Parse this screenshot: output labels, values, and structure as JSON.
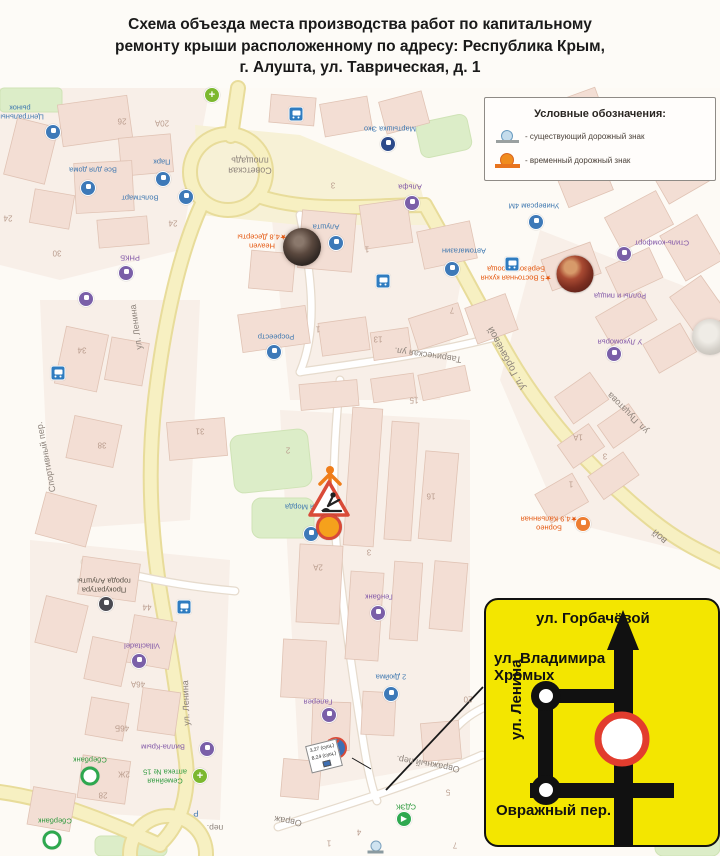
{
  "page": {
    "title": "Схема объезда места производства работ по капитальному\nремонту крыши расположенному по адресу: Республика Крым,\nг. Алушта, ул. Таврическая, д. 1"
  },
  "legend": {
    "title": "Условные обозначения:",
    "items": [
      {
        "kind": "existing-sign-symbol",
        "label": "- существующий дорожный знак"
      },
      {
        "kind": "temporary-sign-symbol",
        "label": "- временный дорожный знак"
      }
    ]
  },
  "work_signs": {
    "temporary_sign_number": "3.2",
    "existing_sign_row1": "3.27 (сущ.)",
    "existing_sign_row2": "8.24 (сущ.)"
  },
  "inset": {
    "street_top": "ул. Горбачёвой",
    "street_left": "ул. Владимира\nХромых",
    "street_vertical": "ул. Ленина",
    "street_bottom": "Овражный пер."
  },
  "colors": {
    "inset_background": "#f3e600",
    "prohibition_ring": "#e23d2e",
    "temporary_sign": "#f08c1e",
    "existing_sign": "#c4dcec",
    "main_road": "#f7f0c2"
  },
  "map": {
    "labels": [
      {
        "t": "Центральный\nрынок",
        "x": 20,
        "y": 112,
        "r": 180,
        "c": "blue",
        "s": 7.5
      },
      {
        "t": "26",
        "x": 122,
        "y": 121,
        "r": 180,
        "c": "num",
        "s": 8
      },
      {
        "t": "20А",
        "x": 162,
        "y": 123,
        "r": 180,
        "c": "num",
        "s": 8
      },
      {
        "t": "Все для дома",
        "x": 93,
        "y": 169,
        "r": 180,
        "c": "blue",
        "s": 7.5
      },
      {
        "t": "Парк",
        "x": 162,
        "y": 161,
        "r": 180,
        "c": "blue",
        "s": 7.5
      },
      {
        "t": "Вольтмарт",
        "x": 140,
        "y": 197,
        "r": 180,
        "c": "blue",
        "s": 7.5
      },
      {
        "t": "24",
        "x": 173,
        "y": 223,
        "r": 180,
        "c": "num",
        "s": 8
      },
      {
        "t": "24",
        "x": 8,
        "y": 218,
        "r": 180,
        "c": "num",
        "s": 8
      },
      {
        "t": "30",
        "x": 57,
        "y": 253,
        "r": 180,
        "c": "num",
        "s": 8
      },
      {
        "t": "РНКБ",
        "x": 130,
        "y": 257,
        "r": 180,
        "c": "purple",
        "s": 7.5
      },
      {
        "t": "Советская\nплощадь",
        "x": 250,
        "y": 165,
        "r": 180,
        "c": "street",
        "s": 9
      },
      {
        "t": "Мартышка Эко",
        "x": 390,
        "y": 128,
        "r": 180,
        "c": "blue",
        "s": 7.5
      },
      {
        "t": "Альфа",
        "x": 410,
        "y": 186,
        "r": 180,
        "c": "purple",
        "s": 7.5
      },
      {
        "t": "3",
        "x": 333,
        "y": 185,
        "r": 180,
        "c": "num",
        "s": 8
      },
      {
        "t": "Алушта",
        "x": 326,
        "y": 226,
        "r": 180,
        "c": "blue",
        "s": 7.5
      },
      {
        "t": "1",
        "x": 367,
        "y": 249,
        "r": 180,
        "c": "num",
        "s": 8
      },
      {
        "t": "Heaven\n★4.8 Десерты",
        "x": 262,
        "y": 241,
        "r": 180,
        "c": "orange",
        "s": 7.5
      },
      {
        "t": "Автомагазин",
        "x": 464,
        "y": 250,
        "r": 180,
        "c": "blue",
        "s": 7.5
      },
      {
        "t": "1А",
        "x": 383,
        "y": 282,
        "r": 180,
        "c": "num",
        "s": 8
      },
      {
        "t": "Универсам 4М",
        "x": 534,
        "y": 205,
        "r": 180,
        "c": "blue",
        "s": 7.5
      },
      {
        "t": "Стиль-комфорт",
        "x": 662,
        "y": 242,
        "r": 180,
        "c": "purple",
        "s": 7.5
      },
      {
        "t": "★5 Восточная кухня\nБерёзовая роща",
        "x": 516,
        "y": 273,
        "r": 180,
        "c": "orange",
        "s": 7.5
      },
      {
        "t": "Роллы и пицца",
        "x": 620,
        "y": 295,
        "r": 180,
        "c": "purple",
        "s": 7.5
      },
      {
        "t": "У Лукоморья",
        "x": 620,
        "y": 341,
        "r": 180,
        "c": "purple",
        "s": 7.5
      },
      {
        "t": "ул. Пуцатова",
        "x": 628,
        "y": 413,
        "r": 225,
        "c": "street",
        "s": 9
      },
      {
        "t": "ул. Горбачёвой",
        "x": 507,
        "y": 358,
        "r": 242,
        "c": "street",
        "s": 10
      },
      {
        "t": "вой",
        "x": 660,
        "y": 536,
        "r": 222,
        "c": "street",
        "s": 10
      },
      {
        "t": "Таврическая ул.",
        "x": 428,
        "y": 355,
        "r": 188,
        "c": "street",
        "s": 9
      },
      {
        "t": "Росреестр",
        "x": 276,
        "y": 336,
        "r": 180,
        "c": "blue",
        "s": 7.5
      },
      {
        "t": "1",
        "x": 318,
        "y": 329,
        "r": 180,
        "c": "num",
        "s": 8
      },
      {
        "t": "13",
        "x": 378,
        "y": 339,
        "r": 180,
        "c": "num",
        "s": 8
      },
      {
        "t": "15",
        "x": 414,
        "y": 400,
        "r": 180,
        "c": "num",
        "s": 8
      },
      {
        "t": "7",
        "x": 452,
        "y": 310,
        "r": 180,
        "c": "num",
        "s": 8
      },
      {
        "t": "ул. Ленина",
        "x": 136,
        "y": 327,
        "r": 262,
        "c": "street",
        "s": 9
      },
      {
        "t": "ул. Ленина",
        "x": 186,
        "y": 703,
        "r": 268,
        "c": "street",
        "s": 9
      },
      {
        "t": "Спортивный пер.",
        "x": 46,
        "y": 457,
        "r": 259,
        "c": "street",
        "s": 9
      },
      {
        "t": "34",
        "x": 82,
        "y": 350,
        "r": 180,
        "c": "num",
        "s": 8
      },
      {
        "t": "38",
        "x": 102,
        "y": 445,
        "r": 180,
        "c": "num",
        "s": 8
      },
      {
        "t": "31",
        "x": 200,
        "y": 431,
        "r": 180,
        "c": "num",
        "s": 8
      },
      {
        "t": "Тайная Морда",
        "x": 310,
        "y": 506,
        "r": 180,
        "c": "blue",
        "s": 7.5
      },
      {
        "t": "16",
        "x": 431,
        "y": 496,
        "r": 180,
        "c": "num",
        "s": 8
      },
      {
        "t": "2А",
        "x": 318,
        "y": 567,
        "r": 180,
        "c": "num",
        "s": 8
      },
      {
        "t": "3",
        "x": 369,
        "y": 552,
        "r": 180,
        "c": "num",
        "s": 8
      },
      {
        "t": "2",
        "x": 288,
        "y": 450,
        "r": 180,
        "c": "num",
        "s": 8
      },
      {
        "t": "Генбанк",
        "x": 379,
        "y": 596,
        "r": 180,
        "c": "purple",
        "s": 7.5
      },
      {
        "t": "Борнео\n★4.9 Кальянная",
        "x": 549,
        "y": 523,
        "r": 180,
        "c": "orange",
        "s": 7.5
      },
      {
        "t": "1А",
        "x": 578,
        "y": 437,
        "r": 180,
        "c": "num",
        "s": 8
      },
      {
        "t": "3",
        "x": 605,
        "y": 456,
        "r": 180,
        "c": "num",
        "s": 8
      },
      {
        "t": "1",
        "x": 571,
        "y": 484,
        "r": 180,
        "c": "num",
        "s": 8
      },
      {
        "t": "Прокуратура\nгорода Алушты",
        "x": 104,
        "y": 585,
        "r": 180,
        "c": "dark",
        "s": 7.5
      },
      {
        "t": "44",
        "x": 147,
        "y": 607,
        "r": 180,
        "c": "num",
        "s": 8
      },
      {
        "t": "Villacitadel",
        "x": 142,
        "y": 645,
        "r": 180,
        "c": "purple",
        "s": 7.5
      },
      {
        "t": "46А",
        "x": 138,
        "y": 684,
        "r": 180,
        "c": "num",
        "s": 8
      },
      {
        "t": "46Б",
        "x": 122,
        "y": 728,
        "r": 180,
        "c": "num",
        "s": 8
      },
      {
        "t": "Сбербанк",
        "x": 90,
        "y": 759,
        "r": 180,
        "c": "green",
        "s": 7.5
      },
      {
        "t": "2Ж",
        "x": 124,
        "y": 774,
        "r": 180,
        "c": "num",
        "s": 8
      },
      {
        "t": "Вилла-Крым",
        "x": 163,
        "y": 746,
        "r": 180,
        "c": "purple",
        "s": 7.5
      },
      {
        "t": "Семейная\nаптека № 15",
        "x": 165,
        "y": 776,
        "r": 180,
        "c": "green",
        "s": 7.5
      },
      {
        "t": "28",
        "x": 103,
        "y": 795,
        "r": 180,
        "c": "num",
        "s": 8
      },
      {
        "t": "Сбербанк",
        "x": 55,
        "y": 820,
        "r": 180,
        "c": "green",
        "s": 7.5
      },
      {
        "t": "Р",
        "x": 196,
        "y": 813,
        "r": 180,
        "c": "blue",
        "s": 8
      },
      {
        "t": "пер.",
        "x": 215,
        "y": 827,
        "r": 180,
        "c": "street",
        "s": 8.5
      },
      {
        "t": "Овражный пер.",
        "x": 428,
        "y": 764,
        "r": 190,
        "c": "street",
        "s": 9
      },
      {
        "t": "Овраж",
        "x": 288,
        "y": 821,
        "r": 190,
        "c": "street",
        "s": 9
      },
      {
        "t": "2 Дюйма",
        "x": 391,
        "y": 676,
        "r": 180,
        "c": "blue",
        "s": 7.5
      },
      {
        "t": "Галерея",
        "x": 318,
        "y": 701,
        "r": 180,
        "c": "purple",
        "s": 7.5
      },
      {
        "t": "20",
        "x": 468,
        "y": 699,
        "r": 180,
        "c": "num",
        "s": 8
      },
      {
        "t": "СДЭК",
        "x": 406,
        "y": 806,
        "r": 180,
        "c": "green",
        "s": 7.5
      },
      {
        "t": "5",
        "x": 448,
        "y": 792,
        "r": 180,
        "c": "num",
        "s": 8
      },
      {
        "t": "4",
        "x": 359,
        "y": 832,
        "r": 180,
        "c": "num",
        "s": 8
      },
      {
        "t": "7",
        "x": 455,
        "y": 845,
        "r": 180,
        "c": "num",
        "s": 8
      },
      {
        "t": "1",
        "x": 329,
        "y": 843,
        "r": 180,
        "c": "num",
        "s": 8
      }
    ],
    "icons": [
      {
        "k": "blue",
        "x": 53,
        "y": 132,
        "n": "market-poi-icon"
      },
      {
        "k": "blue",
        "x": 88,
        "y": 188,
        "n": "vse-dlya-doma-poi-icon"
      },
      {
        "k": "blue",
        "x": 163,
        "y": 179,
        "n": "park-poi-icon"
      },
      {
        "k": "blue",
        "x": 186,
        "y": 197,
        "n": "voltmart-poi-icon"
      },
      {
        "k": "purple",
        "x": 126,
        "y": 273,
        "n": "rnkb-poi-icon"
      },
      {
        "k": "bus",
        "x": 296,
        "y": 114,
        "n": "bus-stop-icon"
      },
      {
        "k": "bus",
        "x": 383,
        "y": 266,
        "n": "bus-stop-icon"
      },
      {
        "k": "bus",
        "x": 512,
        "y": 234,
        "n": "bus-stop-icon"
      },
      {
        "k": "bus",
        "x": 184,
        "y": 562,
        "n": "bus-stop-icon"
      },
      {
        "k": "bus",
        "x": 58,
        "y": 313,
        "n": "bus-stop-icon"
      },
      {
        "k": "darkblue",
        "x": 388,
        "y": 144,
        "n": "martyshka-poi-icon"
      },
      {
        "k": "purple",
        "x": 412,
        "y": 203,
        "n": "alfa-poi-icon"
      },
      {
        "k": "blue",
        "x": 336,
        "y": 243,
        "n": "alushta-poi-icon"
      },
      {
        "k": "blue",
        "x": 452,
        "y": 269,
        "n": "avtomagazin-poi-icon"
      },
      {
        "k": "blue",
        "x": 536,
        "y": 222,
        "n": "universam-poi-icon"
      },
      {
        "k": "purple",
        "x": 624,
        "y": 254,
        "n": "stil-komfort-poi-icon"
      },
      {
        "k": "purple",
        "x": 614,
        "y": 354,
        "n": "lukomorye-poi-icon"
      },
      {
        "k": "blue",
        "x": 274,
        "y": 352,
        "n": "rosreestr-poi-icon"
      },
      {
        "k": "purple",
        "x": 86,
        "y": 299,
        "n": "poi-icon"
      },
      {
        "k": "greenplus",
        "x": 212,
        "y": 95,
        "n": "pharmacy-icon"
      },
      {
        "k": "dark",
        "x": 106,
        "y": 604,
        "n": "prosecutor-poi-icon"
      },
      {
        "k": "purple",
        "x": 139,
        "y": 661,
        "n": "villacitadel-poi-icon"
      },
      {
        "k": "sber",
        "x": 90,
        "y": 776,
        "n": "sberbank-icon"
      },
      {
        "k": "sber",
        "x": 52,
        "y": 840,
        "n": "sberbank-icon"
      },
      {
        "k": "purple",
        "x": 207,
        "y": 749,
        "n": "villa-krym-poi-icon"
      },
      {
        "k": "greenplus",
        "x": 200,
        "y": 776,
        "n": "pharmacy-icon"
      },
      {
        "k": "purple",
        "x": 378,
        "y": 613,
        "n": "genbank-poi-icon"
      },
      {
        "k": "blue",
        "x": 391,
        "y": 694,
        "n": "2-dyuyma-poi-icon"
      },
      {
        "k": "purple",
        "x": 329,
        "y": 715,
        "n": "galereya-poi-icon"
      },
      {
        "k": "cdek",
        "x": 404,
        "y": 819,
        "n": "cdek-icon"
      },
      {
        "k": "orange",
        "x": 583,
        "y": 524,
        "n": "borneo-poi-icon"
      },
      {
        "k": "blue",
        "x": 311,
        "y": 534,
        "n": "poi-icon"
      },
      {
        "k": "food",
        "x": 575,
        "y": 274,
        "n": "restaurant-photo-icon"
      },
      {
        "k": "exmark",
        "x": 376,
        "y": 771,
        "n": "existing-sign-marker"
      },
      {
        "k": "tmpmark",
        "x": 386,
        "y": 791,
        "n": "temporary-sign-marker"
      }
    ]
  }
}
